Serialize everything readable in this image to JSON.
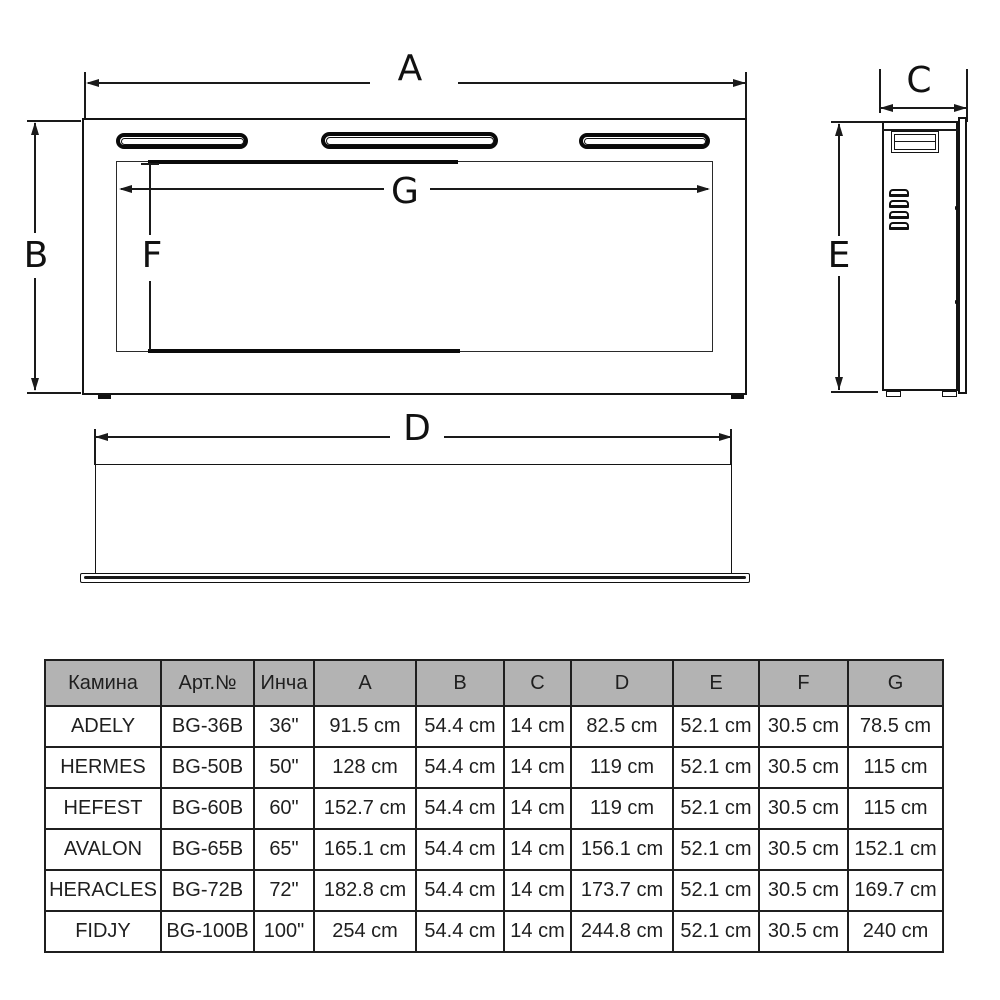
{
  "dim_labels": {
    "a": "A",
    "b": "B",
    "c": "C",
    "d": "D",
    "e": "E",
    "f": "F",
    "g": "G"
  },
  "table": {
    "headers": [
      "Камина",
      "Арт.№",
      "Инча",
      "A",
      "B",
      "C",
      "D",
      "E",
      "F",
      "G"
    ],
    "rows": [
      [
        "ADELY",
        "BG-36B",
        "36\"",
        "91.5 cm",
        "54.4 cm",
        "14 cm",
        "82.5 cm",
        "52.1 cm",
        "30.5 cm",
        "78.5 cm"
      ],
      [
        "HERMES",
        "BG-50B",
        "50\"",
        "128 cm",
        "54.4 cm",
        "14 cm",
        "119 cm",
        "52.1 cm",
        "30.5 cm",
        "115 cm"
      ],
      [
        "HEFEST",
        "BG-60B",
        "60\"",
        "152.7 cm",
        "54.4 cm",
        "14 cm",
        "119 cm",
        "52.1 cm",
        "30.5 cm",
        "115 cm"
      ],
      [
        "AVALON",
        "BG-65B",
        "65\"",
        "165.1 cm",
        "54.4 cm",
        "14 cm",
        "156.1 cm",
        "52.1 cm",
        "30.5 cm",
        "152.1 cm"
      ],
      [
        "HERACLES",
        "BG-72B",
        "72\"",
        "182.8 cm",
        "54.4 cm",
        "14 cm",
        "173.7 cm",
        "52.1 cm",
        "30.5 cm",
        "169.7 cm"
      ],
      [
        "FIDJY",
        "BG-100B",
        "100\"",
        "254 cm",
        "54.4 cm",
        "14 cm",
        "244.8 cm",
        "52.1 cm",
        "30.5 cm",
        "240 cm"
      ]
    ]
  },
  "colors": {
    "header_bg": "#b3b3b3",
    "line": "#1a1a1a",
    "text": "#1f1f1f"
  }
}
